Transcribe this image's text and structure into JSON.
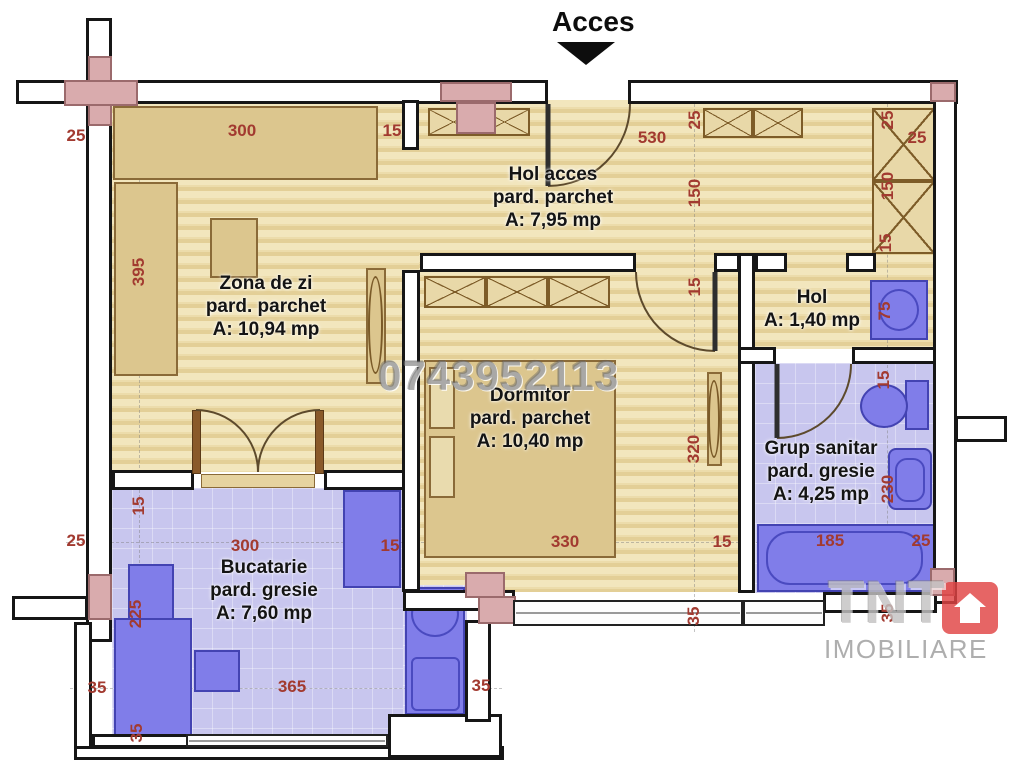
{
  "access_label": "Acces",
  "watermarks": {
    "phone": "0743952113",
    "brand": "TNT",
    "brand_sub": "IMOBILIARE"
  },
  "rooms": [
    {
      "id": "hol-acces",
      "name": "Hol acces",
      "floor": "pard. parchet",
      "area": "A: 7,95 mp"
    },
    {
      "id": "zona-de-zi",
      "name": "Zona de zi",
      "floor": "pard. parchet",
      "area": "A: 10,94 mp"
    },
    {
      "id": "dormitor",
      "name": "Dormitor",
      "floor": "pard. parchet",
      "area": "A: 10,40 mp"
    },
    {
      "id": "hol",
      "name": "Hol",
      "floor": "",
      "area": "A: 1,40 mp"
    },
    {
      "id": "grup-sanitar",
      "name": "Grup sanitar",
      "floor": "pard. gresie",
      "area": "A: 4,25 mp"
    },
    {
      "id": "bucatarie",
      "name": "Bucatarie",
      "floor": "pard. gresie",
      "area": "A: 7,60 mp"
    }
  ],
  "dimensions": [
    {
      "v": "25",
      "x": 76,
      "y": 136,
      "o": "h"
    },
    {
      "v": "300",
      "x": 242,
      "y": 131,
      "o": "h"
    },
    {
      "v": "15",
      "x": 392,
      "y": 131,
      "o": "h"
    },
    {
      "v": "530",
      "x": 652,
      "y": 138,
      "o": "h"
    },
    {
      "v": "25",
      "x": 695,
      "y": 120,
      "o": "v"
    },
    {
      "v": "25",
      "x": 888,
      "y": 120,
      "o": "v"
    },
    {
      "v": "25",
      "x": 917,
      "y": 138,
      "o": "h"
    },
    {
      "v": "150",
      "x": 695,
      "y": 193,
      "o": "v"
    },
    {
      "v": "150",
      "x": 888,
      "y": 186,
      "o": "v"
    },
    {
      "v": "15",
      "x": 886,
      "y": 243,
      "o": "v"
    },
    {
      "v": "395",
      "x": 139,
      "y": 272,
      "o": "v"
    },
    {
      "v": "15",
      "x": 695,
      "y": 287,
      "o": "v"
    },
    {
      "v": "75",
      "x": 885,
      "y": 311,
      "o": "v"
    },
    {
      "v": "15",
      "x": 884,
      "y": 380,
      "o": "v"
    },
    {
      "v": "320",
      "x": 694,
      "y": 449,
      "o": "v"
    },
    {
      "v": "230",
      "x": 888,
      "y": 489,
      "o": "v"
    },
    {
      "v": "25",
      "x": 76,
      "y": 541,
      "o": "h"
    },
    {
      "v": "330",
      "x": 565,
      "y": 542,
      "o": "h"
    },
    {
      "v": "15",
      "x": 722,
      "y": 542,
      "o": "h"
    },
    {
      "v": "185",
      "x": 830,
      "y": 541,
      "o": "h"
    },
    {
      "v": "25",
      "x": 921,
      "y": 541,
      "o": "h"
    },
    {
      "v": "15",
      "x": 139,
      "y": 506,
      "o": "v"
    },
    {
      "v": "300",
      "x": 245,
      "y": 546,
      "o": "h"
    },
    {
      "v": "15",
      "x": 390,
      "y": 546,
      "o": "h"
    },
    {
      "v": "225",
      "x": 136,
      "y": 614,
      "o": "v"
    },
    {
      "v": "35",
      "x": 694,
      "y": 616,
      "o": "v"
    },
    {
      "v": "35",
      "x": 888,
      "y": 613,
      "o": "v"
    },
    {
      "v": "365",
      "x": 292,
      "y": 687,
      "o": "h"
    },
    {
      "v": "35",
      "x": 97,
      "y": 688,
      "o": "h"
    },
    {
      "v": "35",
      "x": 481,
      "y": 686,
      "o": "h"
    },
    {
      "v": "35",
      "x": 137,
      "y": 733,
      "o": "v"
    }
  ],
  "colors": {
    "parquet_light": "#f2e6bd",
    "parquet_dark": "#e3cf97",
    "tile": "#c8c6ee",
    "furniture_wood": "#dcc68e",
    "furniture_blue": "#807de9",
    "column_pink": "#d9abad",
    "dimension_text": "#a23a30",
    "wall_outline": "#161616",
    "accent_red": "#e14444"
  }
}
